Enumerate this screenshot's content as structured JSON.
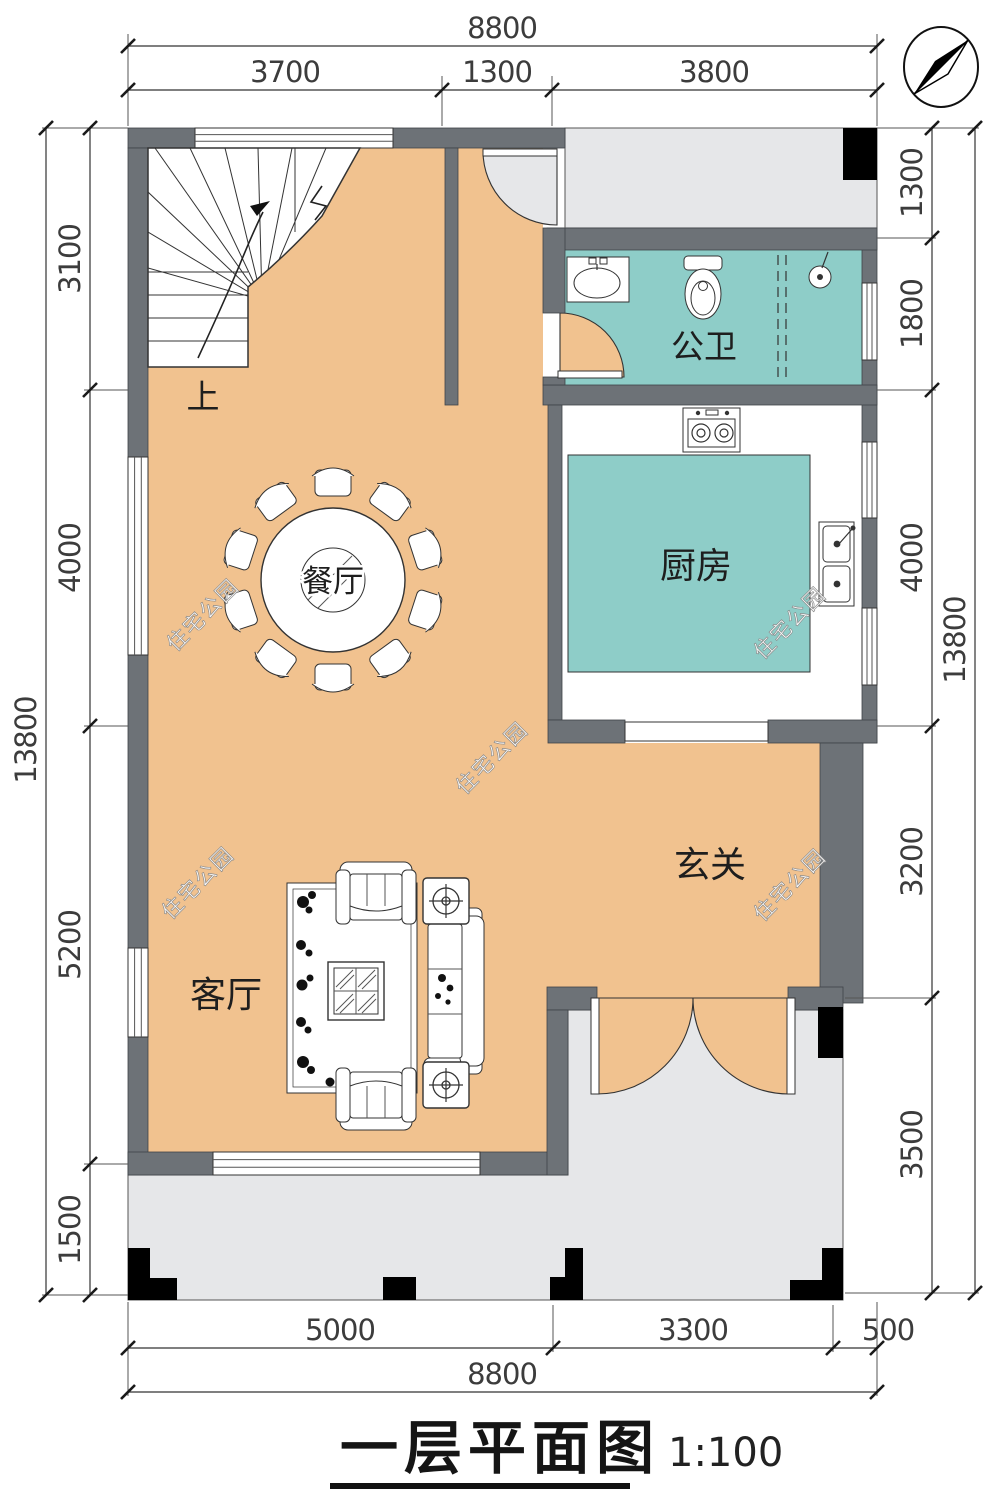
{
  "title": {
    "text": "一层平面图",
    "scale": "1:100"
  },
  "watermark": {
    "text": "住宅公园"
  },
  "compass": {
    "name": "north-arrow"
  },
  "rooms": {
    "dining": "餐厅",
    "kitchen": "厨房",
    "bathroom": "公卫",
    "entry": "玄关",
    "living": "客厅",
    "stair_up": "上"
  },
  "dimensions": {
    "top": {
      "overall": "8800",
      "segments": [
        "3700",
        "1300",
        "3800"
      ]
    },
    "bottom": {
      "overall": "8800",
      "segments": [
        "5000",
        "3300",
        "500"
      ]
    },
    "left": {
      "overall": "13800",
      "segments": [
        "3100",
        "4000",
        "5200",
        "1500"
      ]
    },
    "right": {
      "overall": "13800",
      "segments": [
        "1300",
        "1800",
        "4000",
        "3200",
        "3500"
      ]
    }
  },
  "colors": {
    "floor_orange": "#f1c28f",
    "wet_teal": "#8ecdc8",
    "wall_gray": "#6d7277",
    "porch_gray": "#e6e7e9",
    "column_black": "#000000"
  }
}
